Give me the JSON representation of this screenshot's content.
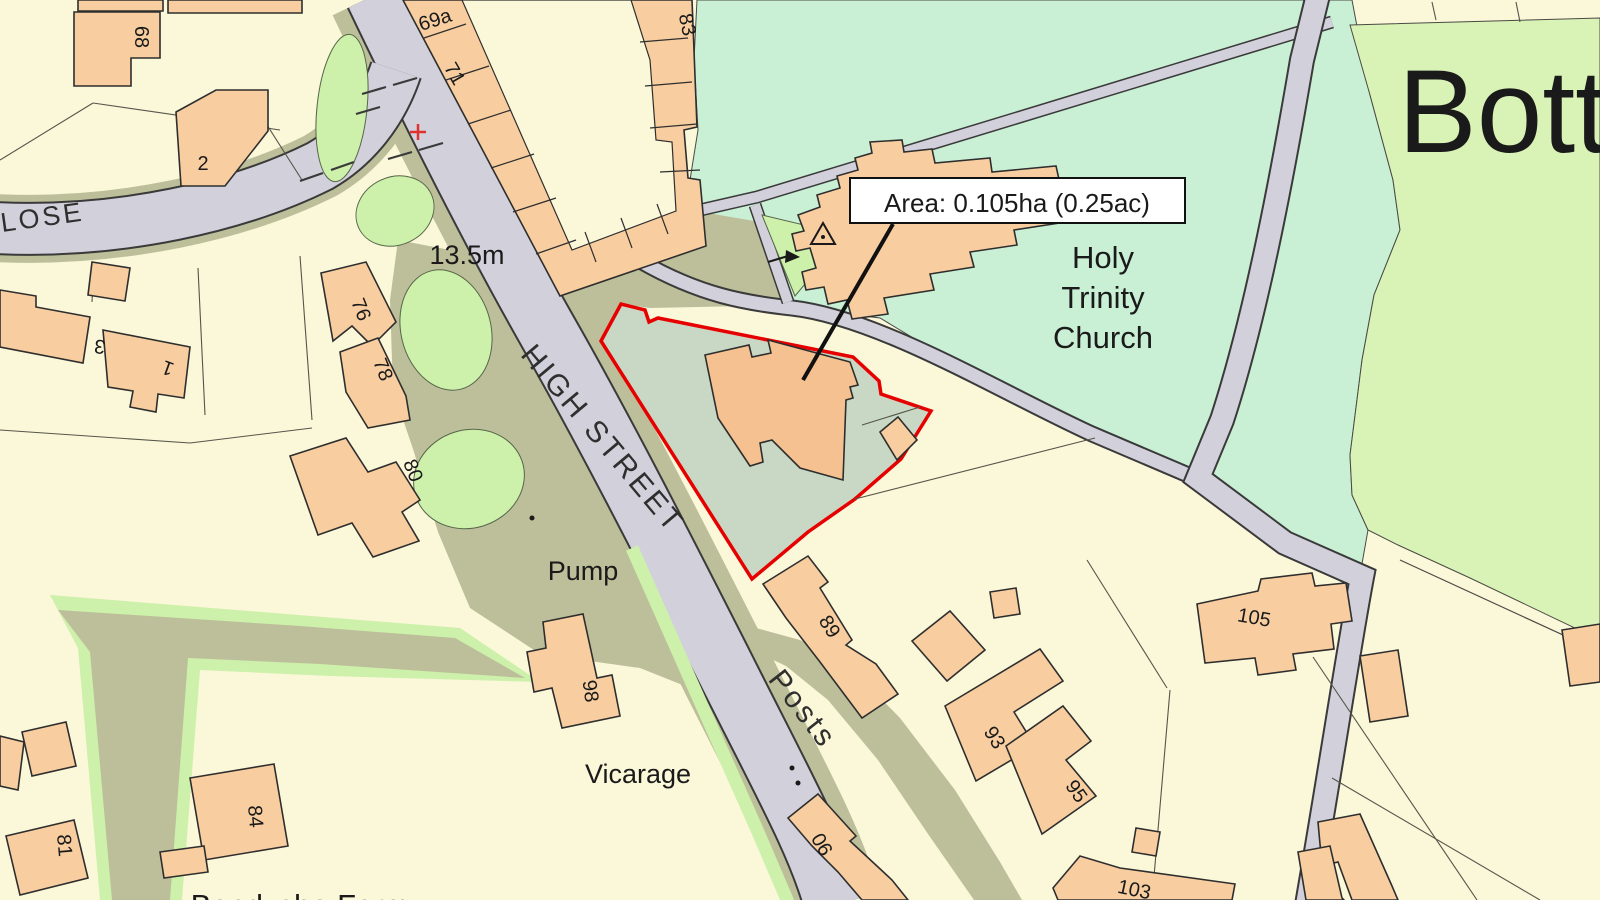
{
  "map": {
    "area_label": {
      "text": "Area: 0.105ha (0.25ac)"
    },
    "streets": {
      "high_street": "HIGH STREET",
      "close_partial": "LOSE"
    },
    "place_labels": {
      "settlement_partial": "Botti",
      "church_line1": "Holy",
      "church_line2": "Trinity",
      "church_line3": "Church",
      "pump": "Pump",
      "posts": "Posts",
      "vicarage": "Vicarage",
      "farm": "Bendyshe Farm",
      "spot_height": "13.5m"
    },
    "house_numbers": [
      {
        "value": "68"
      },
      {
        "value": "2"
      },
      {
        "value": "69a"
      },
      {
        "value": "71"
      },
      {
        "value": "83"
      },
      {
        "value": "3"
      },
      {
        "value": "1"
      },
      {
        "value": "76"
      },
      {
        "value": "78"
      },
      {
        "value": "80"
      },
      {
        "value": "98"
      },
      {
        "value": "84"
      },
      {
        "value": "81"
      },
      {
        "value": "89"
      },
      {
        "value": "90"
      },
      {
        "value": "93"
      },
      {
        "value": "95"
      },
      {
        "value": "103"
      },
      {
        "value": "105"
      }
    ],
    "colors": {
      "site_boundary": "#e60000",
      "parcel_cream": "#fbf7d9",
      "building": "#f8cea0",
      "site_building": "#f6c190",
      "road_gray": "#d2d1db",
      "verge_khaki": "#bdbf9a",
      "churchyard_mint": "#c9efd4",
      "field_green": "#d9f2b6",
      "green_patch": "#cdf0aa",
      "site_area_sage": "#c8d8c4"
    }
  }
}
